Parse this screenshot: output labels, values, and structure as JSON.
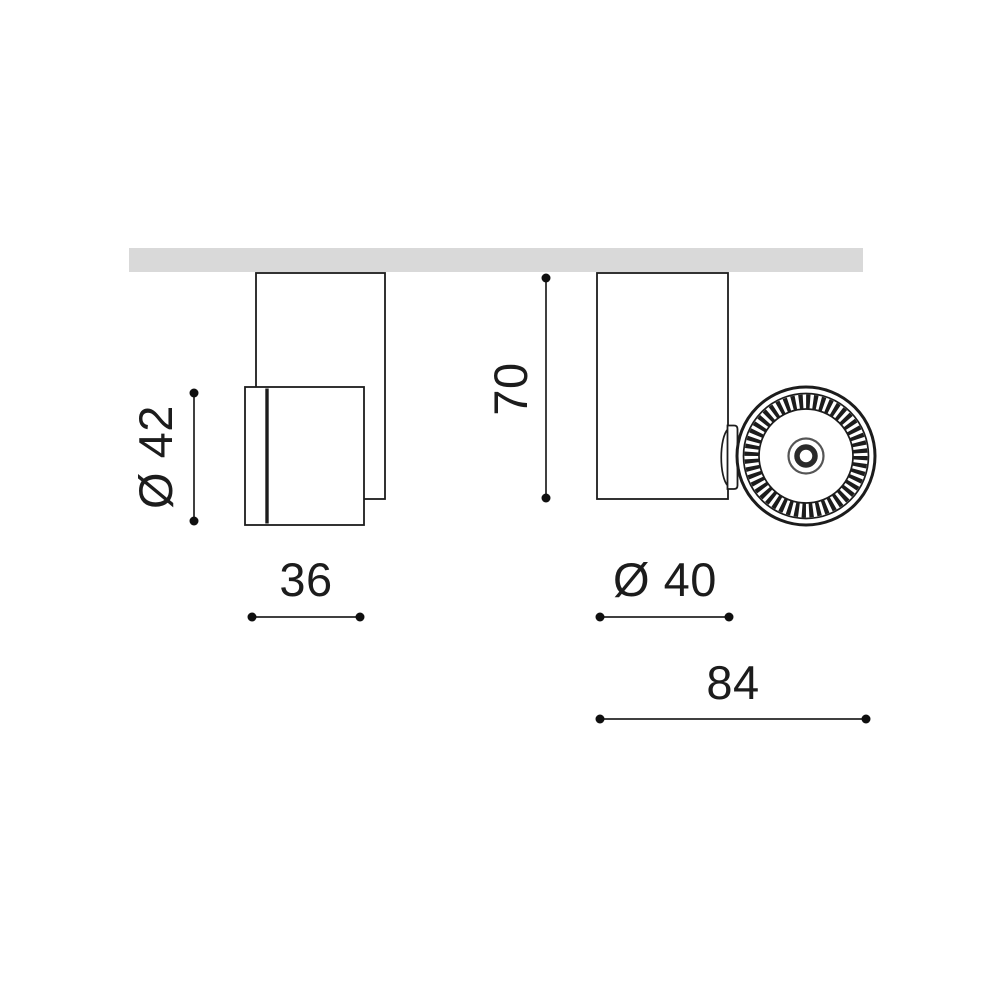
{
  "drawing": {
    "name": "Ceiling spotlight dimensional drawing",
    "colors": {
      "bg": "#ffffff",
      "ceiling": "#d9d9d9",
      "stroke": "#1c1c1c",
      "dim-line": "#404040",
      "dim-dot": "#0f0f0f",
      "dim-text": "#1c1c1c"
    },
    "labels": {
      "head_diameter": "Ø 42",
      "head_depth": "36",
      "body_height": "70",
      "body_diameter": "Ø 40",
      "overall_depth": "84"
    },
    "values": {
      "head_diameter": 42,
      "head_depth": 36,
      "body_height": 70,
      "body_diameter": 40,
      "overall_depth": 84
    }
  }
}
